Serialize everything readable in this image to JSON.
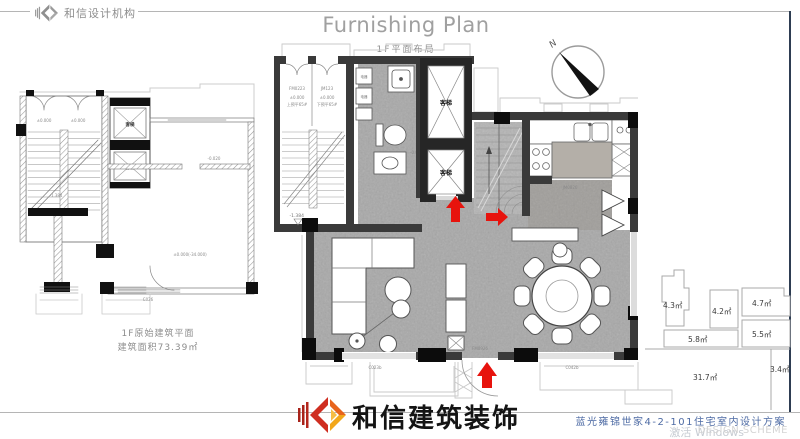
{
  "header": {
    "brand": "和信设计机构",
    "title": "Furnishing Plan",
    "subtitle": "1F平面布局"
  },
  "left_plan": {
    "caption_line1": "1F原始建筑平面",
    "caption_line2": "建筑面积73.39㎡",
    "elevator_label": "客梯",
    "level_zero": "±0.000",
    "level_a": "-1.384",
    "level_b": "±0.000(-34.000)",
    "level_c": "-0.020",
    "window_label": "C026"
  },
  "main_plan": {
    "door_left": "FM0223",
    "door_right": "JM123",
    "level_zero": "±0.000",
    "note_up": "上预平65#",
    "note_down": "下预平65#",
    "appliance": "电器",
    "bath_level": "-0.020",
    "elevator_label": "客梯",
    "kitchen_door": "JM0826",
    "entry_door": "FM0926",
    "window_left": "C023b",
    "window_right": "C042b",
    "living_level": "-1.384"
  },
  "compass": {
    "north": "N"
  },
  "key_plan": {
    "areas": [
      "4.3㎡",
      "4.2㎡",
      "4.7㎡",
      "5.8㎡",
      "5.5㎡",
      "31.7㎡",
      "3.4㎡"
    ]
  },
  "footer": {
    "brand": "和信建筑装饰",
    "project": "蓝光雍锦世家4-2-101住宅室内设计方案",
    "watermark_a": "激活 Windows",
    "watermark_b": "DESIGN SCHEME"
  },
  "colors": {
    "accent_red": "#e7130d",
    "border": "#2e3d52"
  }
}
